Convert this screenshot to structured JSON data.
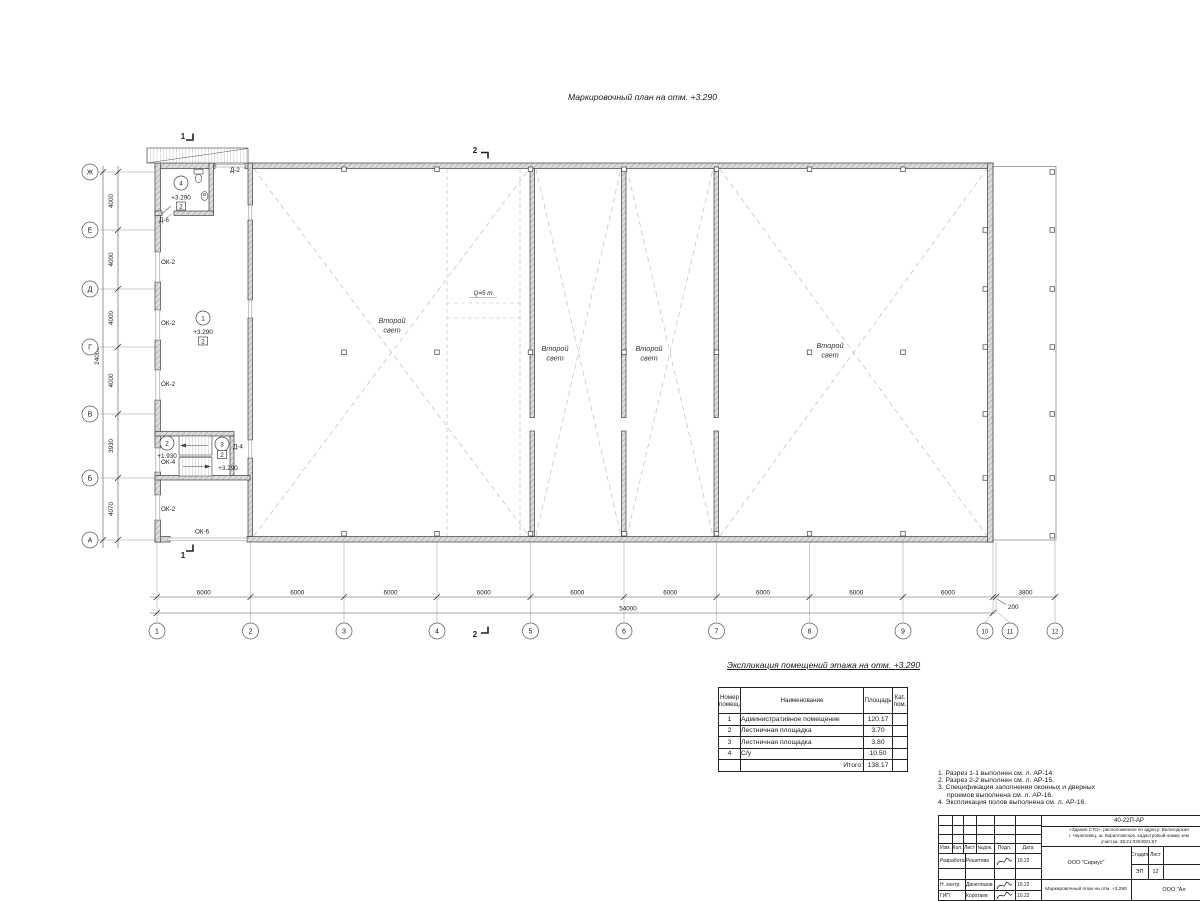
{
  "plan_title": "Маркировочный план на отм. +3.290",
  "axes": {
    "letters": [
      "Ж",
      "Е",
      "Д",
      "Г",
      "В",
      "Б",
      "А"
    ],
    "numbers": [
      "1",
      "2",
      "3",
      "4",
      "5",
      "6",
      "7",
      "8",
      "9",
      "10",
      "11",
      "12"
    ]
  },
  "dims": {
    "left": [
      "4000",
      "4000",
      "4000",
      "4000",
      "3930",
      "4070"
    ],
    "left_total": "24000",
    "bottom": [
      "6000",
      "6000",
      "6000",
      "6000",
      "6000",
      "6000",
      "6000",
      "6000",
      "6000"
    ],
    "gap": "200",
    "annex": "3800",
    "bottom_total": "54000"
  },
  "sections": {
    "s1": "1",
    "s2": "2"
  },
  "crane_label": "Q=5 т",
  "second_light": {
    "l1": "Второй",
    "l2": "свет"
  },
  "rooms": {
    "r1": {
      "num": "1",
      "elev": "+3.290",
      "floor": "2"
    },
    "r2": {
      "num": "2",
      "elev": "+1.930"
    },
    "r3": {
      "num": "3",
      "elev": "+3.290",
      "floor": "2"
    },
    "r4": {
      "num": "4",
      "elev": "+3.290",
      "floor": "2"
    }
  },
  "openings": {
    "d2": "Д-2",
    "d4": "Д-4",
    "d6": "Д-6",
    "ok2": "ОК-2",
    "ok4": "ОК-4",
    "ok6": "ОК-6"
  },
  "explication": {
    "title": "Экспликация помещений этажа на отм. +3.290",
    "headers": {
      "num1": "Номер",
      "num2": "помещ.",
      "name": "Наименование",
      "area": "Площадь",
      "cat1": "Кат.",
      "cat2": "пом."
    },
    "rows": [
      {
        "num": "1",
        "name": "Административное помещение",
        "area": "120.17",
        "cat": ""
      },
      {
        "num": "2",
        "name": "Лестничная площадка",
        "area": "3.70",
        "cat": ""
      },
      {
        "num": "3",
        "name": "Лестничная площадка",
        "area": "3.80",
        "cat": ""
      },
      {
        "num": "4",
        "name": "С/у",
        "area": "10.50",
        "cat": ""
      }
    ],
    "total_label": "Итого:",
    "total_value": "138.17"
  },
  "notes": {
    "l1": "1. Разрез 1-1 выполнен см. л. АР-14.",
    "l2": "2. Разрез 2-2 выполнен см. л. АР-15.",
    "l3": "3. Спецификация заполнения оконных и дверных",
    "l4": "проемов выполнена см. л. АР-16.",
    "l5": "4. Экспликация полов выполнена см. л. АР-16."
  },
  "stamp": {
    "doc_number": "40-22П-АР",
    "address_l1": "«Здание СТО», расположенное по адресу: Вологодская",
    "address_l2": "г. Череповец, ш. Кирилловское, кадастровый номер зем",
    "address_l3": "участка: 35:21:0304001:67",
    "cols": {
      "izm": "Изм.",
      "kol": "Кол.",
      "list": "Лист",
      "ndok": "№док.",
      "podl": "Подл.",
      "data": "Дата"
    },
    "rows": [
      {
        "role": "Разработал",
        "name": "Решетова",
        "date": "10.22"
      },
      {
        "role": "",
        "name": "",
        "date": ""
      },
      {
        "role": "Н. контр.",
        "name": "Двоеглазов",
        "date": "10.22"
      },
      {
        "role": "ГИП",
        "name": "Коротаев",
        "date": "10.22"
      }
    ],
    "org": "ООО \"Сириус\"",
    "stage_label": "Стадия",
    "sheet_label": "Лист",
    "stage": "ЭП",
    "sheet": "12",
    "drawing_title": "Маркировочный план на отм. +3.290",
    "org2": "ООО \"Ал"
  }
}
